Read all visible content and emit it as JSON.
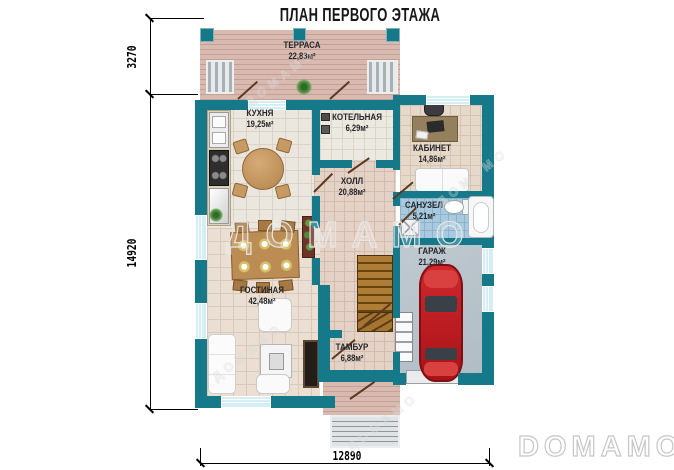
{
  "title": "ПЛАН ПЕРВОГО ЭТАЖА",
  "brand": {
    "watermark": "ДОМАМО",
    "logo": "DOMAMO"
  },
  "dimensions": {
    "terrace_depth": "3270",
    "house_length": "14920",
    "house_width": "12890"
  },
  "rooms": {
    "terrace": {
      "name": "ТЕРРАСА",
      "area": "22,83м²"
    },
    "kitchen": {
      "name": "КУХНЯ",
      "area": "19,25м²"
    },
    "boiler": {
      "name": "КОТЕЛЬНАЯ",
      "area": "6,29м²"
    },
    "office": {
      "name": "КАБИНЕТ",
      "area": "14,86м²"
    },
    "hall": {
      "name": "ХОЛЛ",
      "area": "20,88м²"
    },
    "bathroom": {
      "name": "САНУЗЕЛ",
      "area": "5,21м²"
    },
    "garage": {
      "name": "ГАРАЖ",
      "area": "21,29м²"
    },
    "living": {
      "name": "ГОСТИНАЯ",
      "area": "42,48м²"
    },
    "vestibule": {
      "name": "ТАМБУР",
      "area": "6,88м²"
    }
  },
  "colors": {
    "wall": "#15798a",
    "terrace_deck": "#d9bab0",
    "bath_tile": "#a9cade",
    "garage_floor": "#bac4cb",
    "car_red": "#c41f24",
    "watermark_gray": "#c6c6c6"
  }
}
